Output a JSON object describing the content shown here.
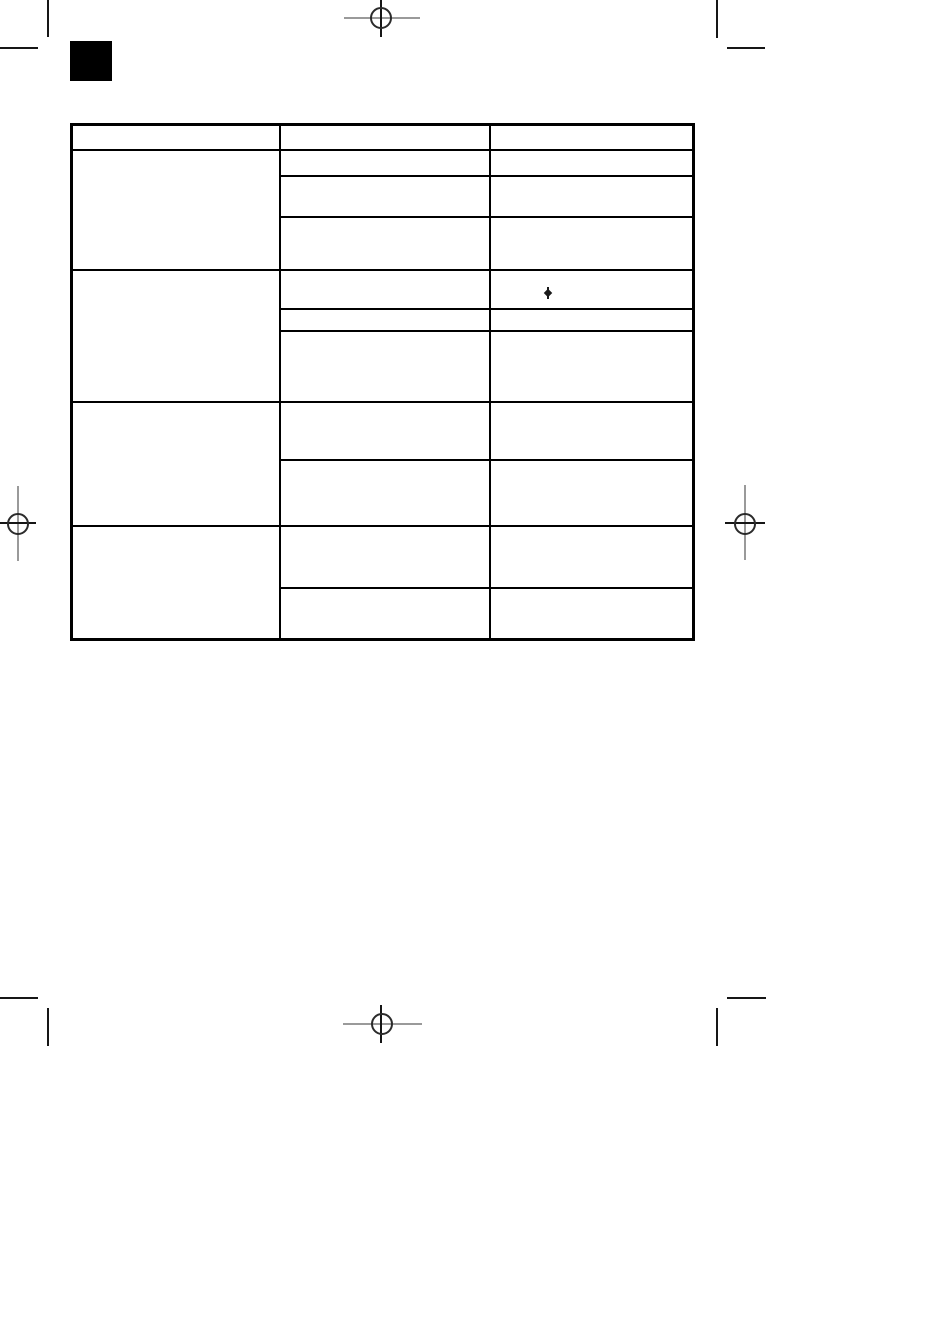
{
  "page": {
    "kind": "scanned print page with empty table grid and printer registration marks",
    "background_color": "#ffffff",
    "ink_color": "#000000",
    "faint_line_color": "#9a9a9a"
  },
  "thumb_tab": {
    "description": "solid black thumb-index square at top left",
    "color": "#000000"
  },
  "table": {
    "border_color": "#000000",
    "column_count": 3,
    "header": [
      "",
      "",
      ""
    ],
    "sections": [
      {
        "left_cell": "",
        "rows": [
          {
            "middle": "",
            "right": ""
          },
          {
            "middle": "",
            "right": ""
          },
          {
            "middle": "",
            "right": ""
          }
        ]
      },
      {
        "left_cell": "",
        "rows": [
          {
            "middle": "",
            "right": "",
            "right_mark": "small-ink-blot"
          },
          {
            "middle": "",
            "right": ""
          },
          {
            "middle": "",
            "right": ""
          }
        ]
      },
      {
        "left_cell": "",
        "rows": [
          {
            "middle": "",
            "right": ""
          },
          {
            "middle": "",
            "right": ""
          }
        ]
      },
      {
        "left_cell": "",
        "rows": [
          {
            "middle": "",
            "right": ""
          },
          {
            "middle": "",
            "right": ""
          }
        ]
      }
    ]
  },
  "stray_mark": {
    "description": "tiny vertical ink blot with diamond center",
    "color": "#1a1a1a"
  },
  "printer_marks": {
    "registration_targets": [
      {
        "name": "top-center-registration-target"
      },
      {
        "name": "left-middle-registration-target"
      },
      {
        "name": "right-middle-registration-target"
      },
      {
        "name": "bottom-center-registration-target"
      }
    ],
    "crop_ticks": [
      {
        "name": "top-left-vertical-tick"
      },
      {
        "name": "top-left-horizontal-tick"
      },
      {
        "name": "top-right-vertical-tick"
      },
      {
        "name": "top-right-horizontal-tick"
      },
      {
        "name": "bottom-left-horizontal-tick"
      },
      {
        "name": "bottom-left-vertical-tick"
      },
      {
        "name": "bottom-right-horizontal-tick"
      },
      {
        "name": "bottom-right-vertical-tick"
      }
    ]
  }
}
